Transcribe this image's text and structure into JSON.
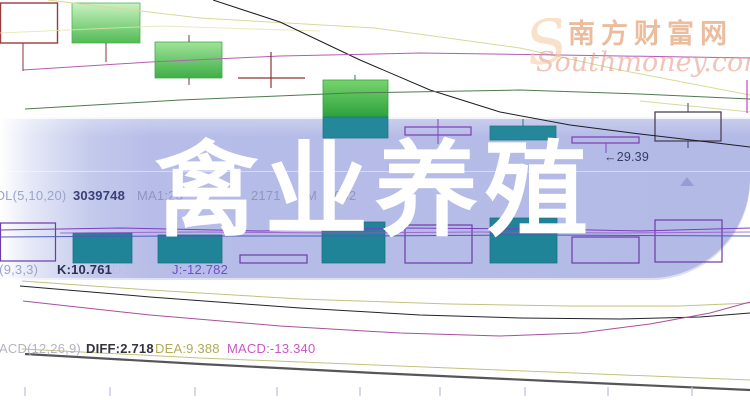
{
  "overlay_title": "禽业养殖",
  "watermark": {
    "brand": "南方财富网",
    "domain": "Southmoney.com",
    "monogram": "S"
  },
  "price_annotation": {
    "arrow": "←",
    "value": "29.39"
  },
  "indicator_rows": {
    "volume": {
      "label": "VOL(5,10,20)",
      "value": "3039748",
      "ma1": "MA1:23",
      "ma2_fragment": "2171",
      "ma3_prefix": "M",
      "ma3_fragment": "652"
    },
    "kdj": {
      "label": "KDJ(9,3,3)",
      "k": "K:10.761",
      "d": "D:22.532",
      "j": "J:-12.782"
    },
    "macd": {
      "label": "MACD(12,26,9)",
      "diff": "DIFF:2.718",
      "dea": "DEA:9.388",
      "macd": "MACD:-13.340"
    }
  },
  "colors": {
    "banner": "#b5bbe7",
    "candle_green": "#3fae47",
    "candle_teal": "#24879a",
    "hollow_purple": "#8247b6",
    "maroon": "#9a3c3c",
    "dea_yellow": "#b2ab55",
    "macd_magenta": "#ca57c9",
    "watermark_orange": "#df9462"
  },
  "chart_data": {
    "type": "candlestick",
    "title": "禽业养殖",
    "annotations": {
      "price_label": 29.39,
      "volume": 3039748,
      "kdj": {
        "k": 10.761,
        "d": 22.532,
        "j": -12.782
      },
      "macd": {
        "diff": 2.718,
        "dea": 9.388,
        "macd": -13.34
      }
    },
    "candle_summary": [
      {
        "pos": 1,
        "style": "hollow-maroon"
      },
      {
        "pos": 2,
        "style": "filled-green"
      },
      {
        "pos": 3,
        "style": "filled-green"
      },
      {
        "pos": 5,
        "style": "filled-green"
      },
      {
        "pos": 6,
        "style": "hollow-purple"
      },
      {
        "pos": 7,
        "style": "filled-teal"
      },
      {
        "pos": 8,
        "style": "hollow-purple",
        "low_label": 29.39
      },
      {
        "pos": 9,
        "style": "hollow-dark"
      }
    ],
    "render": {
      "styles": {
        "green1": {
          "fill": "url(#gradGreen1)",
          "stroke": "#49b04f",
          "sw": 0.75
        },
        "green2": {
          "fill": "url(#gradGreen2)",
          "stroke": "#3aa844",
          "sw": 0.75
        },
        "green3": {
          "fill": "url(#gradGreen3)",
          "stroke": "#2f9e3a",
          "sw": 0.75
        },
        "teal": {
          "fill": "#24879a",
          "stroke": "#1d7386",
          "sw": 0.75
        },
        "tealVol": {
          "fill": "#1f8497",
          "stroke": "#196f81",
          "sw": 0.75
        },
        "hollowMaroon": {
          "fill": "none",
          "stroke": "#9a3c3c",
          "sw": 1.4
        },
        "hollowPurple": {
          "fill": "none",
          "stroke": "#8247b6",
          "sw": 1.3
        },
        "hollowDark": {
          "fill": "none",
          "stroke": "#4e4058",
          "sw": 1.3
        },
        "hollowVol": {
          "fill": "none",
          "stroke": "#6d3aa8",
          "sw": 1.2
        }
      },
      "boxes": [
        {
          "name": "candle-hollow-left",
          "style": "hollowMaroon",
          "x": 0.5,
          "y": 3,
          "w": 57,
          "h": 40
        },
        {
          "name": "candle-green-1",
          "style": "green1",
          "x": 72,
          "y": 3,
          "w": 68,
          "h": 40
        },
        {
          "name": "candle-green-2",
          "style": "green2",
          "x": 155,
          "y": 42,
          "w": 67,
          "h": 36
        },
        {
          "name": "candle-green-3",
          "style": "green3",
          "x": 323,
          "y": 80,
          "w": 65,
          "h": 37
        },
        {
          "name": "candle-green-3-sub",
          "style": "teal",
          "x": 323,
          "y": 117,
          "w": 65,
          "h": 21
        },
        {
          "name": "candle-hollow-a",
          "style": "hollowPurple",
          "x": 405,
          "y": 127,
          "w": 66,
          "h": 8
        },
        {
          "name": "candle-teal-b",
          "style": "teal",
          "x": 490,
          "y": 126,
          "w": 66,
          "h": 14
        },
        {
          "name": "candle-hollow-c",
          "style": "hollowPurple",
          "x": 572,
          "y": 137,
          "w": 67,
          "h": 6
        },
        {
          "name": "candle-hollow-d",
          "style": "hollowDark",
          "x": 655,
          "y": 112,
          "w": 66,
          "h": 29
        },
        {
          "name": "vol-hollow-1",
          "style": "hollowVol",
          "x": 0.5,
          "y": 223,
          "w": 55,
          "h": 38
        },
        {
          "name": "vol-teal-1",
          "style": "tealVol",
          "x": 73,
          "y": 233,
          "w": 59,
          "h": 30
        },
        {
          "name": "vol-teal-2",
          "style": "tealVol",
          "x": 158,
          "y": 235,
          "w": 64,
          "h": 28
        },
        {
          "name": "vol-hollow-2",
          "style": "hollowVol",
          "x": 240,
          "y": 255,
          "w": 67,
          "h": 8
        },
        {
          "name": "vol-teal-3",
          "style": "tealVol",
          "x": 322,
          "y": 222,
          "w": 63,
          "h": 41
        },
        {
          "name": "vol-hollow-3",
          "style": "hollowVol",
          "x": 405,
          "y": 225,
          "w": 67,
          "h": 38
        },
        {
          "name": "vol-teal-4",
          "style": "tealVol",
          "x": 490,
          "y": 218,
          "w": 67,
          "h": 45
        },
        {
          "name": "vol-hollow-4",
          "style": "hollowVol",
          "x": 572,
          "y": 237,
          "w": 67,
          "h": 26
        },
        {
          "name": "vol-hollow-5",
          "style": "hollowVol",
          "x": 655,
          "y": 220,
          "w": 67,
          "h": 42
        }
      ],
      "curves": [
        {
          "name": "ma-pale-top",
          "pts": "48,0 200,18 375,28 520,48 620,70 750,95",
          "color": "#d8d89a",
          "w": 1
        },
        {
          "name": "ma-pale-short",
          "pts": "0,33 160,26 320,31",
          "color": "#e4e4b0",
          "w": 1,
          "o": 0.8
        },
        {
          "name": "ma-pale-right",
          "pts": "640,101 750,112",
          "color": "#d8d89a",
          "w": 1
        },
        {
          "name": "price-black-ma",
          "pts": "213,0 280,22 360,60 430,90 500,112 570,125 640,134 700,141 750,147",
          "color": "#1c1c24",
          "w": 1
        },
        {
          "name": "price-magenta-ma",
          "pts": "23,70 150,62 280,56 420,53 560,55 750,58",
          "color": "#b45cb4",
          "w": 1
        },
        {
          "name": "price-green-ma",
          "pts": "25,109 180,100 350,93 520,90 640,94 750,99",
          "color": "#4e7a50",
          "w": 1
        },
        {
          "name": "vol-ma-purple",
          "pts": "0,230 120,228 260,231 400,228 540,229 640,231 750,228",
          "color": "#7a3fc0",
          "w": 1
        },
        {
          "name": "vol-ma-violet",
          "pts": "60,233 200,232 340,233 480,232 620,233 750,232",
          "color": "#9a55c8",
          "w": 1,
          "o": 0.8
        },
        {
          "name": "vol-ma-blue",
          "pts": "0,237 180,236 360,236 540,235 750,236",
          "color": "#4a5fb0",
          "w": 1
        },
        {
          "name": "kdj-d-curve",
          "pts": "22,281 150,290 300,299 450,304 570,306 680,306 750,303",
          "color": "#c2c27e",
          "w": 1
        },
        {
          "name": "kdj-k-curve",
          "pts": "20,286 150,297 300,308 420,315 520,318 620,319 700,317 750,313",
          "color": "#22222a",
          "w": 1
        },
        {
          "name": "kdj-j-curve",
          "pts": "23,301 150,315 280,326 400,333 500,336 580,333 650,324 710,313 750,302",
          "color": "#a84f9e",
          "w": 1
        },
        {
          "name": "macd-dea-curve",
          "pts": "22,349 200,358 375,365 550,372 750,380",
          "color": "#c2c27e",
          "w": 1
        },
        {
          "name": "macd-dif-curve",
          "pts": "25,354 200,364 375,373 550,381 750,390",
          "color": "#55555a",
          "w": 2.2
        }
      ],
      "segments": [
        {
          "name": "maroon-connector",
          "x1": 23,
          "y1": 43,
          "x2": 23,
          "y2": 71,
          "color": "#8b3434",
          "w": 1
        },
        {
          "name": "wick",
          "x1": 106,
          "y1": 43,
          "x2": 106,
          "y2": 62,
          "color": "#8b3434",
          "w": 1
        },
        {
          "name": "wick",
          "x1": 189,
          "y1": 35,
          "x2": 189,
          "y2": 42,
          "color": "#6b4040",
          "w": 1
        },
        {
          "name": "wick",
          "x1": 189,
          "y1": 78,
          "x2": 189,
          "y2": 85,
          "color": "#6b4040",
          "w": 1
        },
        {
          "name": "cross-h",
          "x1": 238,
          "y1": 78,
          "x2": 305,
          "y2": 78,
          "color": "#8b3434",
          "w": 1.2
        },
        {
          "name": "cross-v",
          "x1": 271,
          "y1": 52,
          "x2": 271,
          "y2": 88,
          "color": "#8b3434",
          "w": 1.2
        },
        {
          "name": "wick",
          "x1": 355,
          "y1": 75,
          "x2": 355,
          "y2": 80,
          "color": "#2f7a34",
          "w": 1
        },
        {
          "name": "wick",
          "x1": 438,
          "y1": 119,
          "x2": 438,
          "y2": 144,
          "color": "#8247b6",
          "w": 1
        },
        {
          "name": "wick",
          "x1": 523,
          "y1": 119,
          "x2": 523,
          "y2": 126,
          "color": "#1f7387",
          "w": 1
        },
        {
          "name": "wick",
          "x1": 606,
          "y1": 143,
          "x2": 606,
          "y2": 153,
          "color": "#8247b6",
          "w": 1
        },
        {
          "name": "wick",
          "x1": 688,
          "y1": 103,
          "x2": 688,
          "y2": 112,
          "color": "#4e4058",
          "w": 1
        },
        {
          "name": "wick",
          "x1": 688,
          "y1": 141,
          "x2": 688,
          "y2": 148,
          "color": "#4e4058",
          "w": 1
        },
        {
          "name": "right-edge-mark",
          "x1": 747,
          "y1": 80,
          "x2": 747,
          "y2": 113,
          "color": "#c048b8",
          "w": 1.2
        }
      ],
      "ticks": [
        25,
        110,
        195,
        277,
        360,
        440,
        525,
        608,
        692
      ],
      "tick_y1": 387,
      "tick_y2": 396,
      "tick_color": "#bcbce4"
    }
  }
}
